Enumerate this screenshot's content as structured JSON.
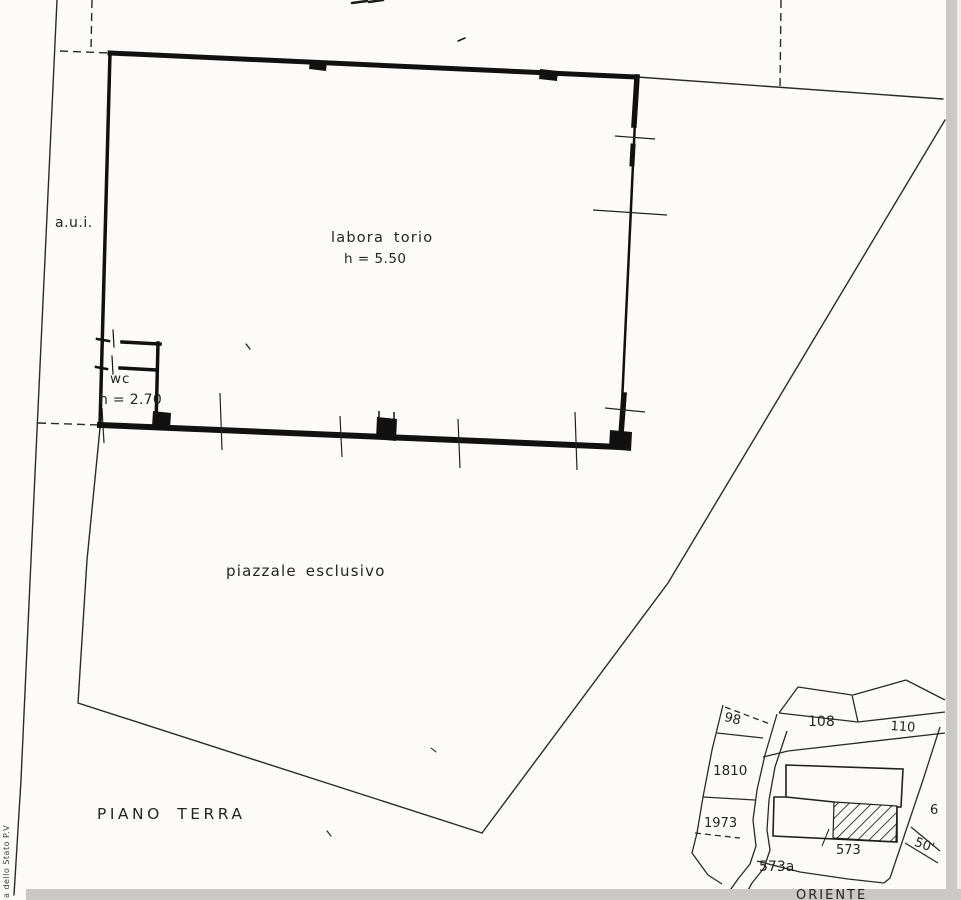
{
  "drawing": {
    "title": "PIANO  TERRA",
    "side_note": "a dello Stato   P.V",
    "rooms": {
      "laboratory": {
        "label": "labora torio",
        "height_note": "h = 5.50"
      },
      "wc": {
        "label": "wc",
        "height_note": "h = 2.70"
      }
    },
    "areas": {
      "courtyard": "piazzale esclusivo",
      "adjacent_strip": "a.u.i."
    },
    "colors": {
      "ink": "#1b1b1b",
      "paper": "#fcfbf9",
      "scan_edge": "#cac9c7"
    }
  },
  "cadastral_inset": {
    "parcels": [
      "98",
      "108",
      "110",
      "1810",
      "1973",
      "573a",
      "573",
      "50'",
      "6"
    ],
    "caption_fragment": "ORIENTE"
  }
}
